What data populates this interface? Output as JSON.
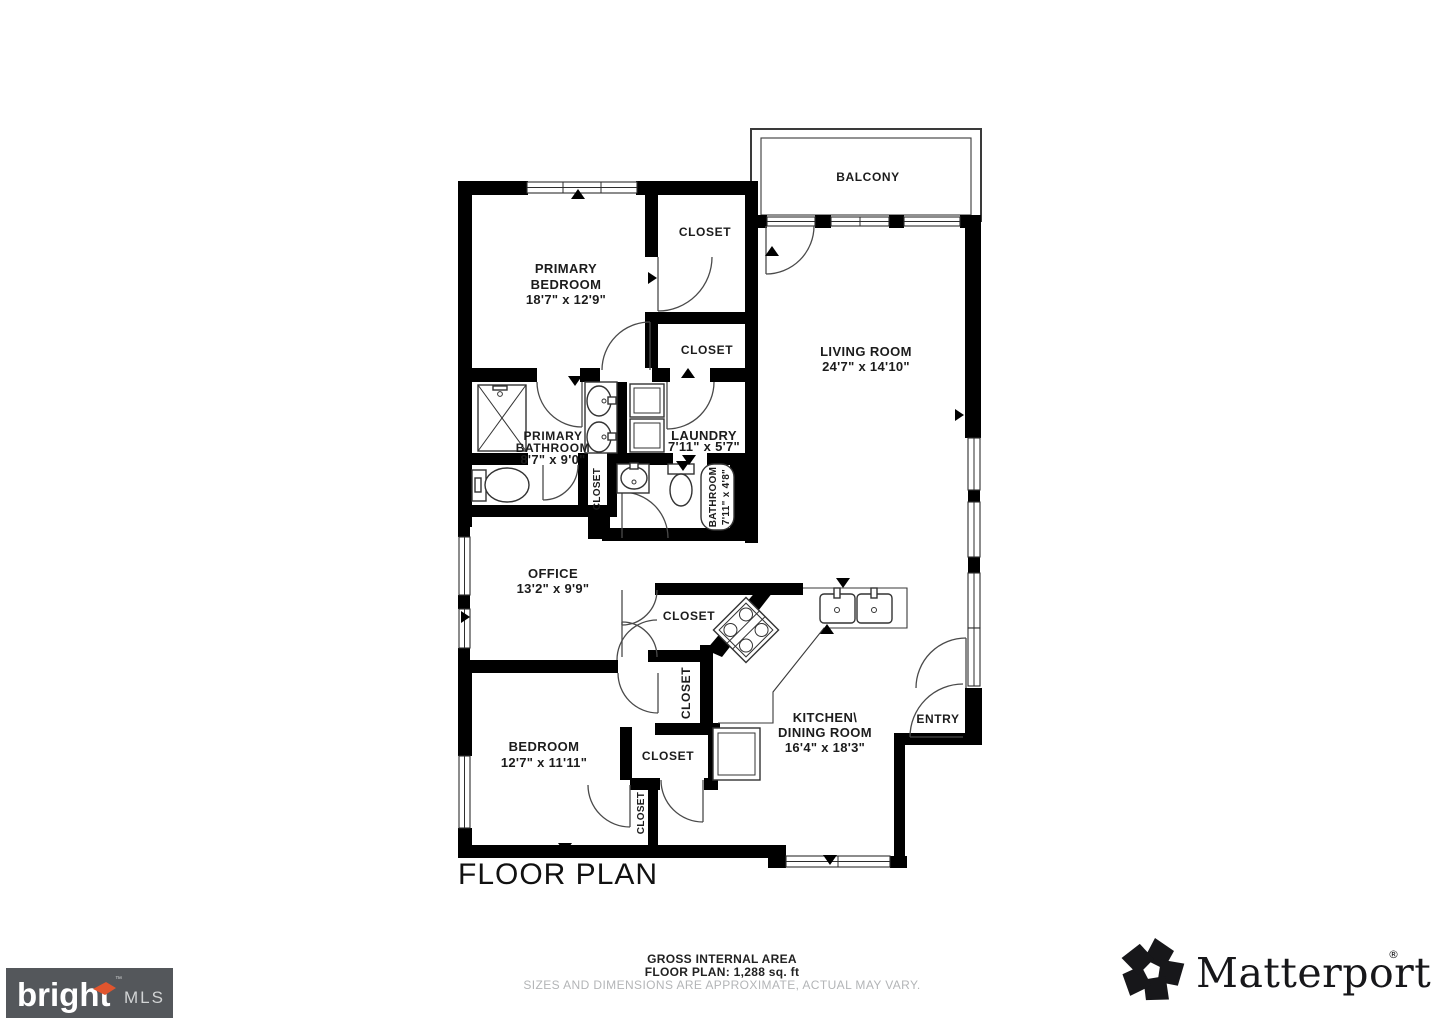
{
  "title": "FLOOR PLAN",
  "rooms": {
    "balcony": {
      "name": "BALCONY"
    },
    "primary_bedroom": {
      "name1": "PRIMARY",
      "name2": "BEDROOM",
      "dims": "18'7\" x 12'9\""
    },
    "closet_primary_top": {
      "name": "CLOSET"
    },
    "closet_primary_mid": {
      "name": "CLOSET"
    },
    "living_room": {
      "name": "LIVING ROOM",
      "dims": "24'7\" x 14'10\""
    },
    "primary_bathroom": {
      "name1": "PRIMARY",
      "name2": "BATHROOM",
      "dims": "8'7\" x 9'0\""
    },
    "laundry": {
      "name": "LAUNDRY",
      "dims": "7'11\" x 5'7\""
    },
    "closet_hall": {
      "name": "CLOSET"
    },
    "bathroom": {
      "name": "BATHROOM",
      "dims": "7'11\" x 4'8\""
    },
    "office": {
      "name": "OFFICE",
      "dims": "13'2\" x 9'9\""
    },
    "closet_office": {
      "name": "CLOSET"
    },
    "closet_hall2": {
      "name": "CLOSET"
    },
    "closet_bedroom": {
      "name": "CLOSET"
    },
    "closet_bedroom2": {
      "name": "CLOSET"
    },
    "bedroom": {
      "name": "BEDROOM",
      "dims": "12'7\" x 11'11\""
    },
    "kitchen": {
      "name1": "KITCHEN\\",
      "name2": "DINING ROOM",
      "dims": "16'4\" x 18'3\""
    },
    "entry": {
      "name": "ENTRY"
    }
  },
  "footer": {
    "area_title": "GROSS INTERNAL AREA",
    "area_value": "FLOOR PLAN: 1,288 sq. ft",
    "disclaimer": "SIZES AND DIMENSIONS ARE APPROXIMATE, ACTUAL MAY VARY."
  },
  "branding": {
    "bright": {
      "word": "bright",
      "suffix": "MLS",
      "tm": "™"
    },
    "matterport": {
      "word": "Matterport",
      "reg": "®"
    }
  },
  "colors": {
    "wall": "#000000",
    "disclaimer_gray": "#b3b5b7",
    "bright_bg": "#54575b",
    "bright_accent": "#e0552e",
    "matterport_black": "#17171a"
  }
}
